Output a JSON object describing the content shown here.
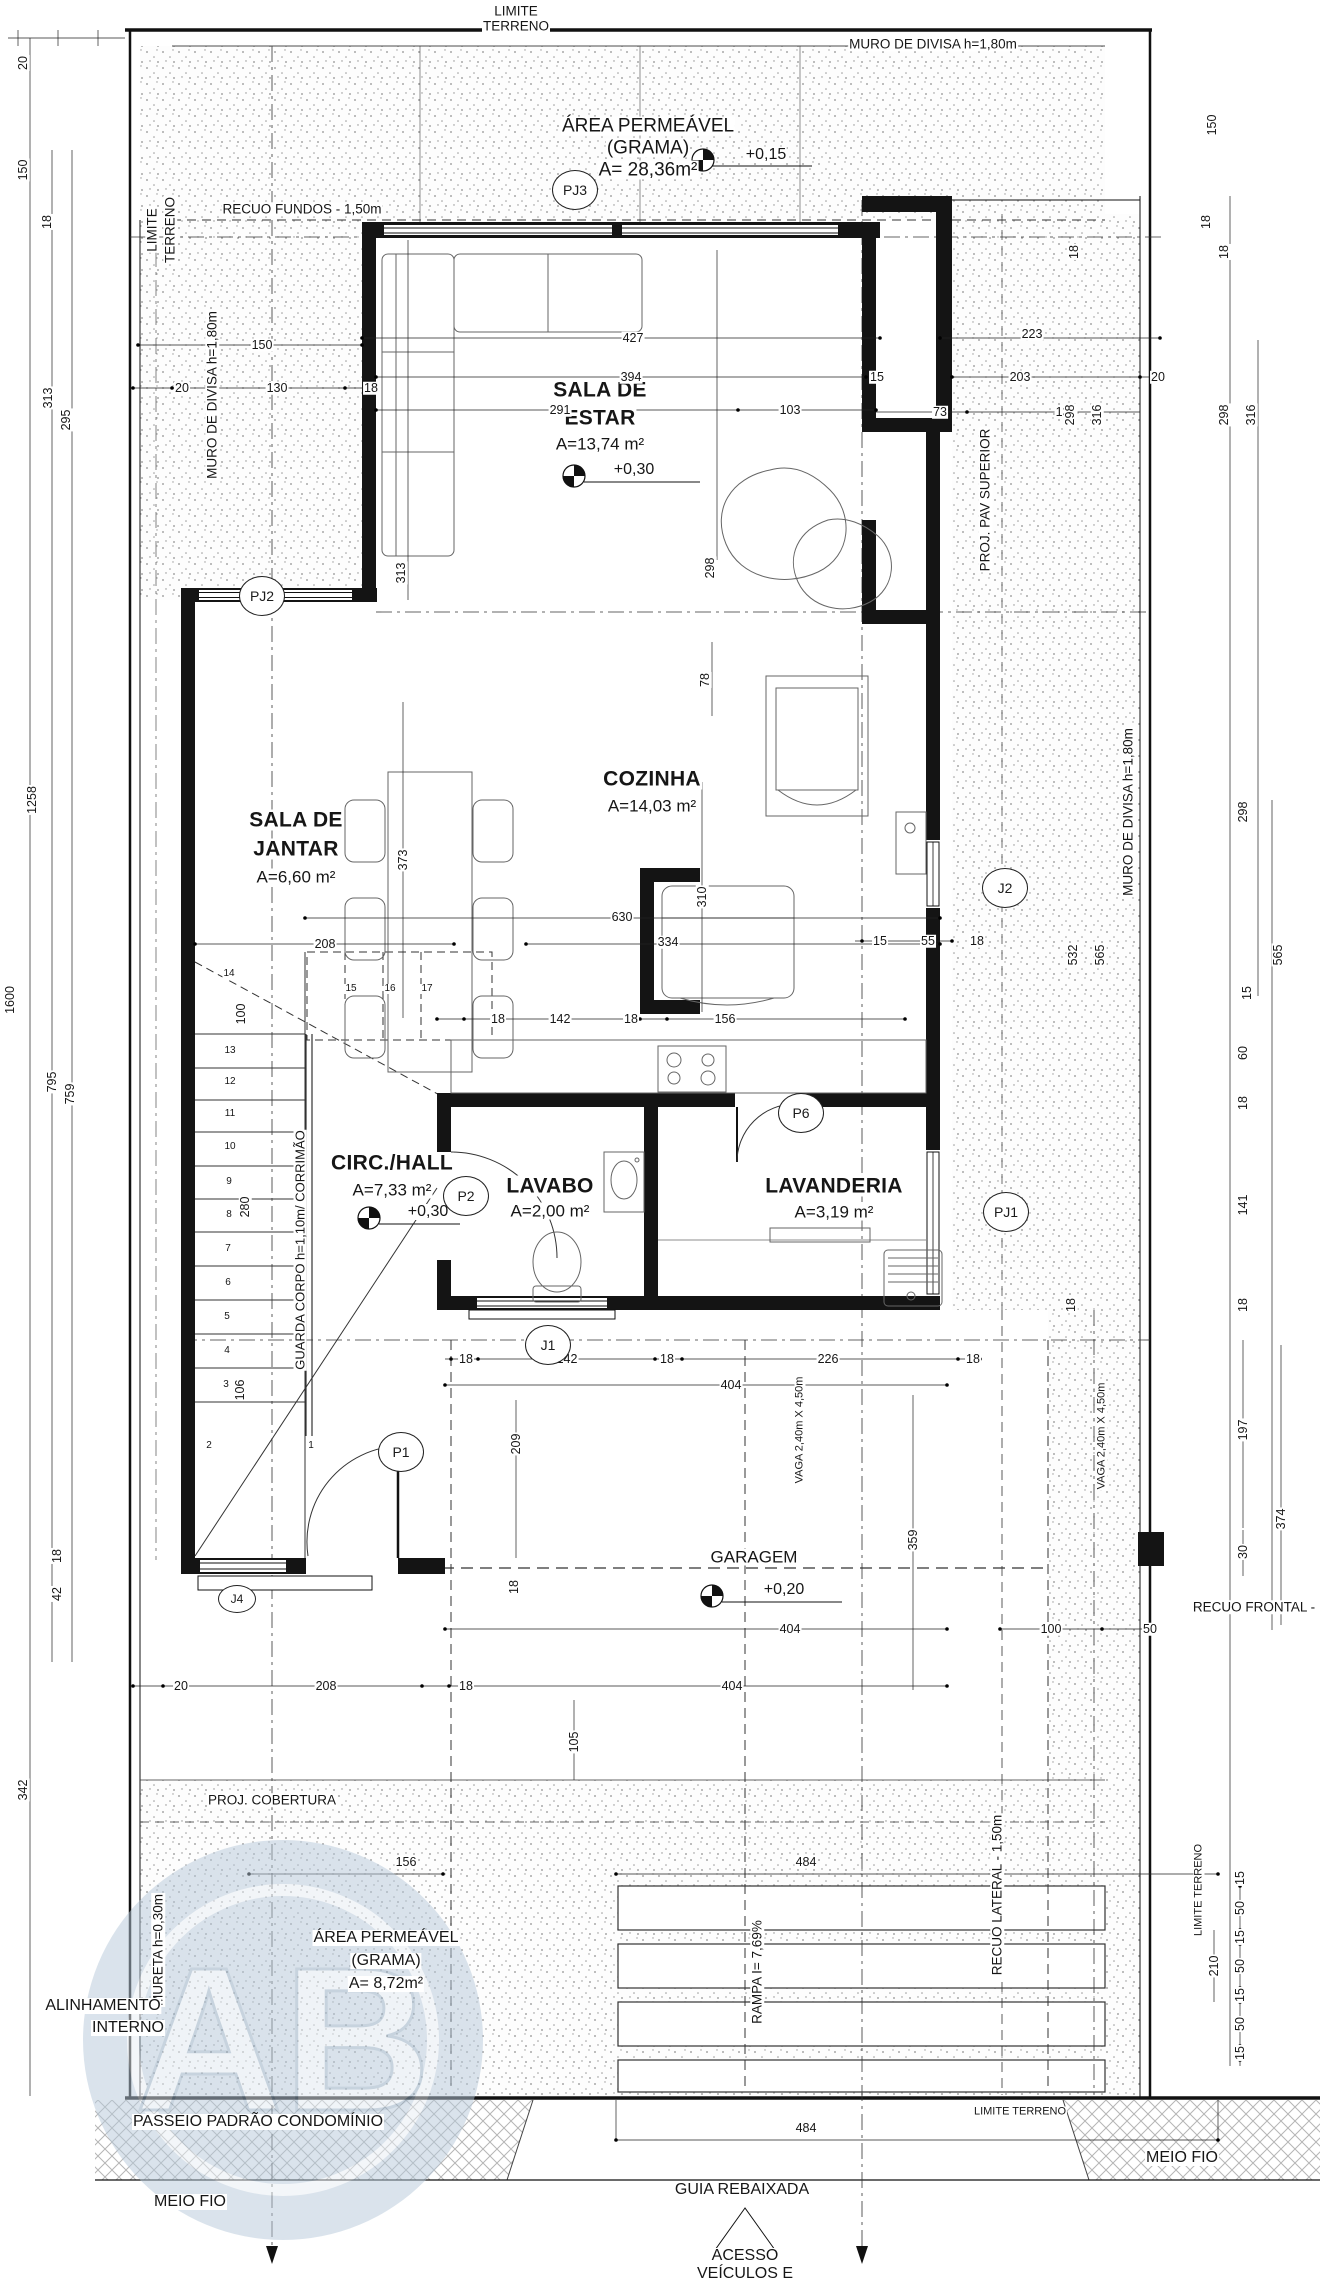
{
  "watermark": {
    "letters": "AB"
  },
  "colors": {
    "ink": "#161616",
    "stipple": "#8f8f8f",
    "hatch": "#b5b5b5",
    "watermark_fill": "#b7c9da",
    "watermark_text": "#e3ebf2"
  },
  "bubbles": [
    {
      "t": "PJ3",
      "x": 575,
      "y": 190
    },
    {
      "t": "PJ2",
      "x": 262,
      "y": 596
    },
    {
      "t": "J2",
      "x": 1005,
      "y": 888
    },
    {
      "t": "P6",
      "x": 801,
      "y": 1113
    },
    {
      "t": "P2",
      "x": 466,
      "y": 1196
    },
    {
      "t": "PJ1",
      "x": 1006,
      "y": 1212
    },
    {
      "t": "J1",
      "x": 548,
      "y": 1345
    },
    {
      "t": "P1",
      "x": 401,
      "y": 1452
    },
    {
      "t": "J4",
      "x": 237,
      "y": 1599,
      "s": "small"
    }
  ],
  "labels": [
    {
      "t": "LIMITE",
      "x": 516,
      "y": 11,
      "c": "an",
      "n": "site-limit-top"
    },
    {
      "t": "TERRENO",
      "x": 516,
      "y": 26,
      "c": "an",
      "n": "site-limit-top"
    },
    {
      "t": "MURO DE DIVISA h=1,80m",
      "x": 933,
      "y": 44,
      "c": "an",
      "n": "wall-note"
    },
    {
      "t": "ÁREA PERMEÁVEL",
      "x": 648,
      "y": 126,
      "c": "ap",
      "n": "permeable-area-title"
    },
    {
      "t": "(GRAMA)",
      "x": 648,
      "y": 148,
      "c": "ap"
    },
    {
      "t": "A= 28,36m²",
      "x": 648,
      "y": 170,
      "c": "ap"
    },
    {
      "t": "+0,15",
      "x": 766,
      "y": 155,
      "c": "lv",
      "n": "level-value"
    },
    {
      "t": "RECUO FUNDOS - 1,50m",
      "x": 302,
      "y": 209,
      "c": "an",
      "n": "setback-note"
    },
    {
      "t": "LIMITE",
      "x": 152,
      "y": 230,
      "r": -90,
      "c": "an"
    },
    {
      "t": "TERRENO",
      "x": 170,
      "y": 230,
      "r": -90,
      "c": "an"
    },
    {
      "t": "MURO DE DIVISA h=1,80m",
      "x": 212,
      "y": 395,
      "r": -90,
      "c": "an",
      "n": "wall-note"
    },
    {
      "t": "PROJ. PAV SUPERIOR",
      "x": 985,
      "y": 500,
      "r": -90,
      "c": "an",
      "n": "upper-floor-projection-note"
    },
    {
      "t": "MURO DE DIVISA h=1,80m",
      "x": 1128,
      "y": 812,
      "r": -90,
      "c": "an",
      "n": "wall-note"
    },
    {
      "t": "SALA DE",
      "x": 600,
      "y": 390,
      "c": "rm",
      "n": "room-sala-estar"
    },
    {
      "t": "ESTAR",
      "x": 600,
      "y": 418,
      "c": "rm",
      "n": "room-sala-estar"
    },
    {
      "t": "A=13,74 m²",
      "x": 600,
      "y": 444,
      "c": "ra",
      "n": "room-area"
    },
    {
      "t": "+0,30",
      "x": 634,
      "y": 470,
      "c": "lv",
      "n": "level-value"
    },
    {
      "t": "SALA DE",
      "x": 296,
      "y": 820,
      "c": "rm",
      "n": "room-sala-jantar"
    },
    {
      "t": "JANTAR",
      "x": 296,
      "y": 849,
      "c": "rm",
      "n": "room-sala-jantar"
    },
    {
      "t": "A=6,60 m²",
      "x": 296,
      "y": 877,
      "c": "ra",
      "n": "room-area"
    },
    {
      "t": "COZINHA",
      "x": 652,
      "y": 779,
      "c": "rm",
      "n": "room-cozinha"
    },
    {
      "t": "A=14,03 m²",
      "x": 652,
      "y": 806,
      "c": "ra",
      "n": "room-area"
    },
    {
      "t": "CIRC./HALL",
      "x": 392,
      "y": 1163,
      "c": "rm",
      "n": "room-circ-hall"
    },
    {
      "t": "A=7,33 m²",
      "x": 392,
      "y": 1190,
      "c": "ra",
      "n": "room-area"
    },
    {
      "t": "+0,30",
      "x": 428,
      "y": 1212,
      "c": "lv",
      "n": "level-value"
    },
    {
      "t": "LAVABO",
      "x": 550,
      "y": 1186,
      "c": "rm",
      "n": "room-lavabo"
    },
    {
      "t": "A=2,00 m²",
      "x": 550,
      "y": 1211,
      "c": "ra",
      "n": "room-area"
    },
    {
      "t": "LAVANDERIA",
      "x": 834,
      "y": 1186,
      "c": "rm",
      "n": "room-lavanderia"
    },
    {
      "t": "A=3,19 m²",
      "x": 834,
      "y": 1212,
      "c": "ra",
      "n": "room-area"
    },
    {
      "t": "GUARDA CORPO h=1,10m/ CORRIMÃO",
      "x": 300,
      "y": 1250,
      "r": -90,
      "c": "gc",
      "n": "guardrail-note"
    },
    {
      "t": "GARAGEM",
      "x": 754,
      "y": 1557,
      "c": "ra",
      "n": "room-garagem"
    },
    {
      "t": "+0,20",
      "x": 784,
      "y": 1590,
      "c": "lv",
      "n": "level-value"
    },
    {
      "t": "VAGA 2,40m X 4,50m",
      "x": 800,
      "y": 1430,
      "r": -90,
      "c": "an2",
      "n": "parking-space-note"
    },
    {
      "t": "VAGA 2,40m X 4,50m",
      "x": 1102,
      "y": 1436,
      "r": -90,
      "c": "an2",
      "n": "parking-space-note"
    },
    {
      "t": "RECUO FRONTAL -",
      "x": 1254,
      "y": 1607,
      "c": "an",
      "n": "setback-note"
    },
    {
      "t": "PROJ. COBERTURA",
      "x": 272,
      "y": 1800,
      "c": "an",
      "n": "roof-projection-note"
    },
    {
      "t": "ÁREA PERMEÁVEL",
      "x": 386,
      "y": 1938,
      "c": "ap2",
      "n": "permeable-area-title"
    },
    {
      "t": "(GRAMA)",
      "x": 386,
      "y": 1961,
      "c": "ap2"
    },
    {
      "t": "A= 8,72m²",
      "x": 386,
      "y": 1984,
      "c": "ap2"
    },
    {
      "t": "MURETA h=0,30m",
      "x": 158,
      "y": 1950,
      "r": -90,
      "c": "an",
      "n": "low-wall-note"
    },
    {
      "t": "RAMPA I= 7,69%",
      "x": 757,
      "y": 1972,
      "r": -90,
      "c": "an",
      "n": "ramp-note"
    },
    {
      "t": "RECUO LATERAL - 1,50m",
      "x": 997,
      "y": 1895,
      "r": -90,
      "c": "an",
      "n": "setback-note"
    },
    {
      "t": "LIMITE TERRENO",
      "x": 1199,
      "y": 1890,
      "r": -90,
      "c": "an2",
      "n": "site-limit-note"
    },
    {
      "t": "ALINHAMENTO",
      "x": 103,
      "y": 2006,
      "c": "bt",
      "n": "alignment-note"
    },
    {
      "t": "INTERNO",
      "x": 128,
      "y": 2028,
      "c": "bt",
      "n": "alignment-note"
    },
    {
      "t": "PASSEIO PADRÃO CONDOMÍNIO",
      "x": 258,
      "y": 2122,
      "c": "bt",
      "n": "sidewalk-note"
    },
    {
      "t": "LIMITE TERRENO",
      "x": 1020,
      "y": 2112,
      "c": "an2",
      "n": "site-limit-note"
    },
    {
      "t": "MEIO FIO",
      "x": 190,
      "y": 2202,
      "c": "bt",
      "n": "curb-note"
    },
    {
      "t": "MEIO FIO",
      "x": 1182,
      "y": 2158,
      "c": "bt",
      "n": "curb-note"
    },
    {
      "t": "GUIA REBAIXADA",
      "x": 742,
      "y": 2190,
      "c": "bt",
      "n": "lowered-curb-note"
    },
    {
      "t": "ACESSO",
      "x": 745,
      "y": 2256,
      "c": "bt",
      "n": "access-note"
    },
    {
      "t": "VEÍCULOS E",
      "x": 745,
      "y": 2274,
      "c": "bt",
      "n": "access-note"
    },
    {
      "t": "PEDESTRES",
      "x": 745,
      "y": 2293,
      "c": "bt",
      "n": "access-note"
    },
    {
      "t": "20",
      "x": 23,
      "y": 63,
      "r": -90
    },
    {
      "t": "150",
      "x": 23,
      "y": 170,
      "r": -90
    },
    {
      "t": "18",
      "x": 47,
      "y": 222,
      "r": -90
    },
    {
      "t": "313",
      "x": 48,
      "y": 398,
      "r": -90
    },
    {
      "t": "295",
      "x": 66,
      "y": 420,
      "r": -90
    },
    {
      "t": "1258",
      "x": 32,
      "y": 800,
      "r": -90
    },
    {
      "t": "1600",
      "x": 10,
      "y": 1000,
      "r": -90
    },
    {
      "t": "795",
      "x": 52,
      "y": 1082,
      "r": -90
    },
    {
      "t": "759",
      "x": 70,
      "y": 1094,
      "r": -90
    },
    {
      "t": "18",
      "x": 57,
      "y": 1556,
      "r": -90
    },
    {
      "t": "42",
      "x": 57,
      "y": 1594,
      "r": -90
    },
    {
      "t": "342",
      "x": 23,
      "y": 1790,
      "r": -90
    },
    {
      "t": "150",
      "x": 1212,
      "y": 125,
      "r": -90
    },
    {
      "t": "18",
      "x": 1206,
      "y": 222,
      "r": -90
    },
    {
      "t": "150",
      "x": 262,
      "y": 345
    },
    {
      "t": "20",
      "x": 182,
      "y": 388
    },
    {
      "t": "130",
      "x": 277,
      "y": 388
    },
    {
      "t": "18",
      "x": 371,
      "y": 388
    },
    {
      "t": "427",
      "x": 633,
      "y": 338
    },
    {
      "t": "394",
      "x": 631,
      "y": 377
    },
    {
      "t": "291",
      "x": 560,
      "y": 410
    },
    {
      "t": "103",
      "x": 790,
      "y": 410
    },
    {
      "t": "15",
      "x": 877,
      "y": 377
    },
    {
      "t": "223",
      "x": 1032,
      "y": 334
    },
    {
      "t": "203",
      "x": 1020,
      "y": 377
    },
    {
      "t": "20",
      "x": 1158,
      "y": 377
    },
    {
      "t": "73",
      "x": 940,
      "y": 412
    },
    {
      "t": "130",
      "x": 1066,
      "y": 412
    },
    {
      "t": "18",
      "x": 1074,
      "y": 252,
      "r": -90
    },
    {
      "t": "18",
      "x": 1224,
      "y": 252,
      "r": -90
    },
    {
      "t": "298",
      "x": 1070,
      "y": 415,
      "r": -90
    },
    {
      "t": "316",
      "x": 1097,
      "y": 415,
      "r": -90
    },
    {
      "t": "298",
      "x": 1224,
      "y": 415,
      "r": -90
    },
    {
      "t": "316",
      "x": 1251,
      "y": 415,
      "r": -90
    },
    {
      "t": "313",
      "x": 401,
      "y": 573,
      "r": -90
    },
    {
      "t": "298",
      "x": 710,
      "y": 568,
      "r": -90
    },
    {
      "t": "78",
      "x": 705,
      "y": 680,
      "r": -90
    },
    {
      "t": "298",
      "x": 1243,
      "y": 812,
      "r": -90
    },
    {
      "t": "532",
      "x": 1073,
      "y": 955,
      "r": -90
    },
    {
      "t": "565",
      "x": 1100,
      "y": 955,
      "r": -90
    },
    {
      "t": "565",
      "x": 1278,
      "y": 955,
      "r": -90
    },
    {
      "t": "15",
      "x": 1247,
      "y": 993,
      "r": -90
    },
    {
      "t": "60",
      "x": 1243,
      "y": 1053,
      "r": -90
    },
    {
      "t": "18",
      "x": 1243,
      "y": 1103,
      "r": -90
    },
    {
      "t": "141",
      "x": 1243,
      "y": 1205,
      "r": -90
    },
    {
      "t": "18",
      "x": 1071,
      "y": 1305,
      "r": -90
    },
    {
      "t": "18",
      "x": 1243,
      "y": 1305,
      "r": -90
    },
    {
      "t": "15",
      "x": 880,
      "y": 941
    },
    {
      "t": "55",
      "x": 928,
      "y": 941
    },
    {
      "t": "18",
      "x": 977,
      "y": 941
    },
    {
      "t": "630",
      "x": 622,
      "y": 917
    },
    {
      "t": "310",
      "x": 702,
      "y": 897,
      "r": -90
    },
    {
      "t": "208",
      "x": 325,
      "y": 944
    },
    {
      "t": "334",
      "x": 668,
      "y": 942
    },
    {
      "t": "373",
      "x": 403,
      "y": 860,
      "r": -90
    },
    {
      "t": "18",
      "x": 498,
      "y": 1019
    },
    {
      "t": "142",
      "x": 560,
      "y": 1019
    },
    {
      "t": "18",
      "x": 631,
      "y": 1019
    },
    {
      "t": "156",
      "x": 725,
      "y": 1019
    },
    {
      "t": "14",
      "x": 229,
      "y": 974,
      "c": "ds"
    },
    {
      "t": "15",
      "x": 351,
      "y": 989,
      "c": "ds"
    },
    {
      "t": "16",
      "x": 390,
      "y": 989,
      "c": "ds"
    },
    {
      "t": "17",
      "x": 427,
      "y": 989,
      "c": "ds"
    },
    {
      "t": "100",
      "x": 241,
      "y": 1014,
      "r": -90
    },
    {
      "t": "13",
      "x": 230,
      "y": 1051,
      "c": "ds"
    },
    {
      "t": "12",
      "x": 230,
      "y": 1082,
      "c": "ds"
    },
    {
      "t": "11",
      "x": 230,
      "y": 1114,
      "c": "ds"
    },
    {
      "t": "10",
      "x": 230,
      "y": 1147,
      "c": "ds"
    },
    {
      "t": "9",
      "x": 229,
      "y": 1182,
      "c": "ds"
    },
    {
      "t": "8",
      "x": 229,
      "y": 1215,
      "c": "ds"
    },
    {
      "t": "280",
      "x": 245,
      "y": 1207,
      "r": -90
    },
    {
      "t": "7",
      "x": 228,
      "y": 1249,
      "c": "ds"
    },
    {
      "t": "6",
      "x": 228,
      "y": 1283,
      "c": "ds"
    },
    {
      "t": "5",
      "x": 227,
      "y": 1317,
      "c": "ds"
    },
    {
      "t": "4",
      "x": 227,
      "y": 1351,
      "c": "ds"
    },
    {
      "t": "3",
      "x": 226,
      "y": 1385,
      "c": "ds"
    },
    {
      "t": "106",
      "x": 240,
      "y": 1390,
      "r": -90
    },
    {
      "t": "2",
      "x": 209,
      "y": 1446,
      "c": "ds"
    },
    {
      "t": "1",
      "x": 311,
      "y": 1446,
      "c": "ds"
    },
    {
      "t": "18",
      "x": 466,
      "y": 1359
    },
    {
      "t": "142",
      "x": 567,
      "y": 1359
    },
    {
      "t": "18",
      "x": 667,
      "y": 1359
    },
    {
      "t": "226",
      "x": 828,
      "y": 1359
    },
    {
      "t": "18",
      "x": 973,
      "y": 1359
    },
    {
      "t": "404",
      "x": 731,
      "y": 1385
    },
    {
      "t": "209",
      "x": 516,
      "y": 1444,
      "r": -90
    },
    {
      "t": "359",
      "x": 913,
      "y": 1540,
      "r": -90
    },
    {
      "t": "18",
      "x": 514,
      "y": 1587,
      "r": -90
    },
    {
      "t": "404",
      "x": 790,
      "y": 1629
    },
    {
      "t": "100",
      "x": 1051,
      "y": 1629
    },
    {
      "t": "50",
      "x": 1150,
      "y": 1629
    },
    {
      "t": "197",
      "x": 1243,
      "y": 1430,
      "r": -90
    },
    {
      "t": "374",
      "x": 1281,
      "y": 1519,
      "r": -90
    },
    {
      "t": "30",
      "x": 1243,
      "y": 1552,
      "r": -90
    },
    {
      "t": "20",
      "x": 181,
      "y": 1686
    },
    {
      "t": "208",
      "x": 326,
      "y": 1686
    },
    {
      "t": "18",
      "x": 466,
      "y": 1686
    },
    {
      "t": "404",
      "x": 732,
      "y": 1686
    },
    {
      "t": "105",
      "x": 574,
      "y": 1742,
      "r": -90
    },
    {
      "t": "156",
      "x": 406,
      "y": 1862
    },
    {
      "t": "484",
      "x": 806,
      "y": 1862
    },
    {
      "t": "15",
      "x": 1240,
      "y": 1878,
      "r": -90
    },
    {
      "t": "50",
      "x": 1240,
      "y": 1908,
      "r": -90
    },
    {
      "t": "15",
      "x": 1240,
      "y": 1937,
      "r": -90
    },
    {
      "t": "50",
      "x": 1240,
      "y": 1966,
      "r": -90
    },
    {
      "t": "210",
      "x": 1214,
      "y": 1966,
      "r": -90
    },
    {
      "t": "15",
      "x": 1240,
      "y": 1995,
      "r": -90
    },
    {
      "t": "50",
      "x": 1240,
      "y": 2024,
      "r": -90
    },
    {
      "t": "15",
      "x": 1240,
      "y": 2053,
      "r": -90
    },
    {
      "t": "484",
      "x": 806,
      "y": 2128
    }
  ]
}
